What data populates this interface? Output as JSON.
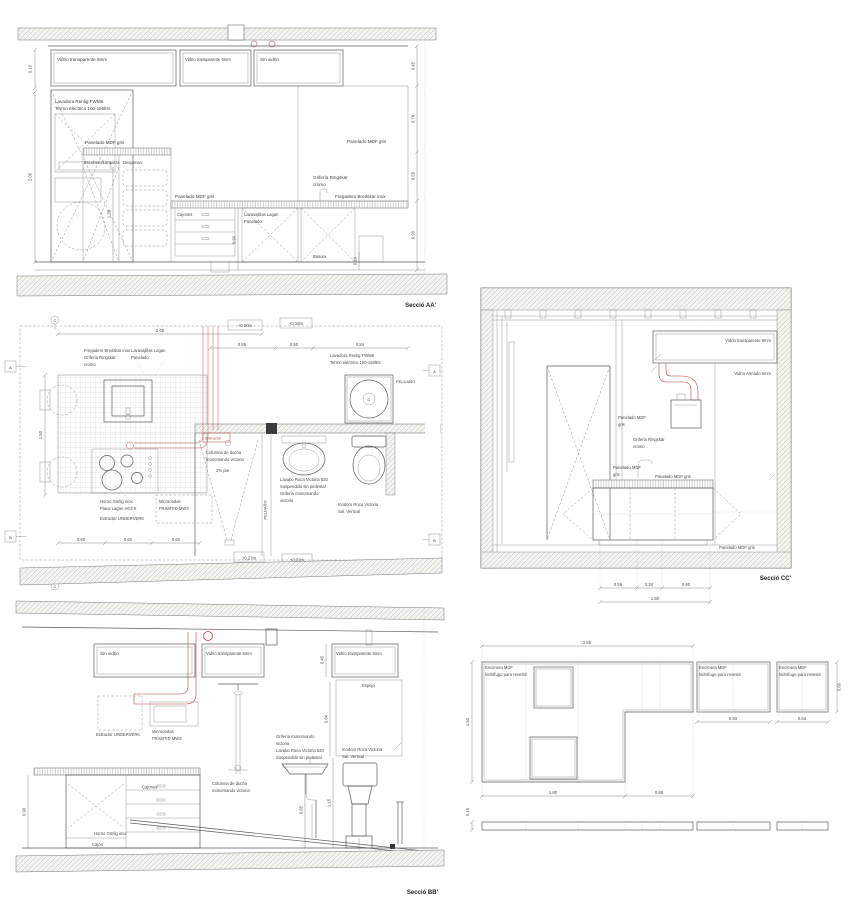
{
  "palette": {
    "paper": "#ffffff",
    "line": "#5a5a5a",
    "hatch": "#b8b8b4",
    "red_accent": "#b5463e",
    "pink_accent": "#c97f8f",
    "text": "#3c3c3c"
  },
  "seccio_aa": {
    "title": "Secció AA'",
    "labels": {
      "glass_left": "Vidrio transparente 6mm",
      "glass_mid": "Vidrio transparente 6mm",
      "glass_right": "Sin vidrio",
      "lavadora_1": "Lavadora Renlig FWM6",
      "lavadora_2": "Termo eléctrico 100-150ltrs",
      "panelado_upper": "Panelado MDF gris",
      "escobero": "Escobero/Limpieza",
      "despensa": "Despensa",
      "panelado_mid": "Panelado MDF gris",
      "panelado_right": "Panelado MDF gris",
      "cajones": "Cajones",
      "lavavajillas_1": "Lavavajillas Lagan",
      "lavavajillas_2": "Panelado",
      "griferia_1": "Grifería Ringskär",
      "griferia_2": "cromo",
      "fregadero": "Fregadero Bredskär inox",
      "basura": "Basura"
    },
    "dims": {
      "left_top": "0.10",
      "left_main": "2.05",
      "inner_tall": "1.39",
      "inner_drawers": "0.90",
      "inner_small": "0.16",
      "right_1": "0.45",
      "right_2": "0.76",
      "right_3": "0.65",
      "right_4": "0.90"
    }
  },
  "plan": {
    "levels": {
      "l0": "+0.00m",
      "l16": "+0.16m",
      "l27": "+0.27m",
      "l32": "+0.32m"
    },
    "dims": {
      "total": "2.65",
      "seg1": "0.85",
      "seg2": "0.50",
      "seg3": "0.84",
      "left": "1.50",
      "mod1": "0.60",
      "mod2": "0.60",
      "mod3": "0.60"
    },
    "markers": {
      "a": "A",
      "b": "B",
      "c": "C",
      "drum": "C"
    },
    "labels": {
      "fregadero_1": "Fregadero Bredskär inox",
      "fregadero_2": "Grifería Ringskär",
      "fregadero_3": "cromo",
      "lavavajillas_1": "Lavavajillas Lagan",
      "lavavajillas_2": "Panelado",
      "lavadora_1": "Lavadora Renlig FWM6",
      "lavadora_2": "Termo eléctrico 100-150ltrs",
      "peldano_right": "PELDAÑO",
      "peldano_mid": "PELDAÑO",
      "extractor": "Extractor",
      "ducha_1": "Columna de ducha",
      "ducha_2": "monomando victoria",
      "ducha_3": "2% pte.",
      "lavabo_1": "Lavabo Roca Victoria 520",
      "lavabo_2": "Suspendido sin pedestal",
      "lavabo_3": "Grifería monomando",
      "lavabo_4": "victoria",
      "inodoro_1": "Inodoro Roca Victoria",
      "inodoro_2": "Sal. Vertical",
      "horno_1": "Horno Görlig inox",
      "horno_2": "Placa Lagan HGCK",
      "horno_3": "Extractor UNDERVERK",
      "micro_1": "Microondas",
      "micro_2": "FRAMTID MW3"
    }
  },
  "seccio_bb": {
    "title": "Secció BB'",
    "labels": {
      "glass_left": "Sin vidrio",
      "glass_mid": "Vidrio transparente 6mm",
      "glass_right": "Vidrio transparente 6mm",
      "espejo": "Espejo",
      "extractor": "Extractor UNDERVERK",
      "micro_1": "Microondas",
      "micro_2": "FRAMTID MW3",
      "ducha_1": "Columna de ducha",
      "ducha_2": "monomando victoria",
      "griferia_1": "Grifería monomando",
      "griferia_2": "victoria",
      "lavabo_1": "Lavabo Roca Victoria 520",
      "lavabo_2": "Suspendido sin pedestal",
      "inodoro_1": "Inodoro Roca Victoria",
      "inodoro_2": "Sal. Vertical",
      "cajones": "Cajones",
      "horno": "Horno Görlig inox",
      "cajon": "Cajón"
    },
    "dims": {
      "glass": "0.45",
      "mirror": "0.84",
      "lavabo": "0.85",
      "inodoro": "1.15",
      "counter": "0.90"
    }
  },
  "seccio_cc": {
    "title": "Secció CC'",
    "labels": {
      "glass": "Vidrio transparente 6mm",
      "armado": "Vidrio Armado 6mm",
      "panelado1_1": "Panelado MDF",
      "panelado1_2": "gris",
      "griferia_1": "Grifería Ringskär",
      "griferia_2": "cromo",
      "panelado2_1": "Panelado MDF",
      "panelado2_2": "gris",
      "panelado3": "Panelado MDF gris",
      "panelado4": "Panelado MDF gris"
    },
    "dims": {
      "d1": "0.56",
      "d2": "0.34",
      "d3": "0.60",
      "total": "1.50"
    }
  },
  "encimera": {
    "labels": {
      "panel1_1": "Encimera MDF",
      "panel1_2": "hidrófugo para revestir",
      "panel2_1": "Encimera MDF",
      "panel2_2": "hidrófugo para revestir",
      "panel3_1": "Encimera MDF",
      "panel3_2": "hidrófugo para revestir"
    },
    "dims": {
      "total": "2.65",
      "left": "1.50",
      "right": "0.60",
      "p2": "0.93",
      "p3": "0.64",
      "leg": "1.80",
      "notch": "0.85",
      "strip": "0.10"
    }
  }
}
